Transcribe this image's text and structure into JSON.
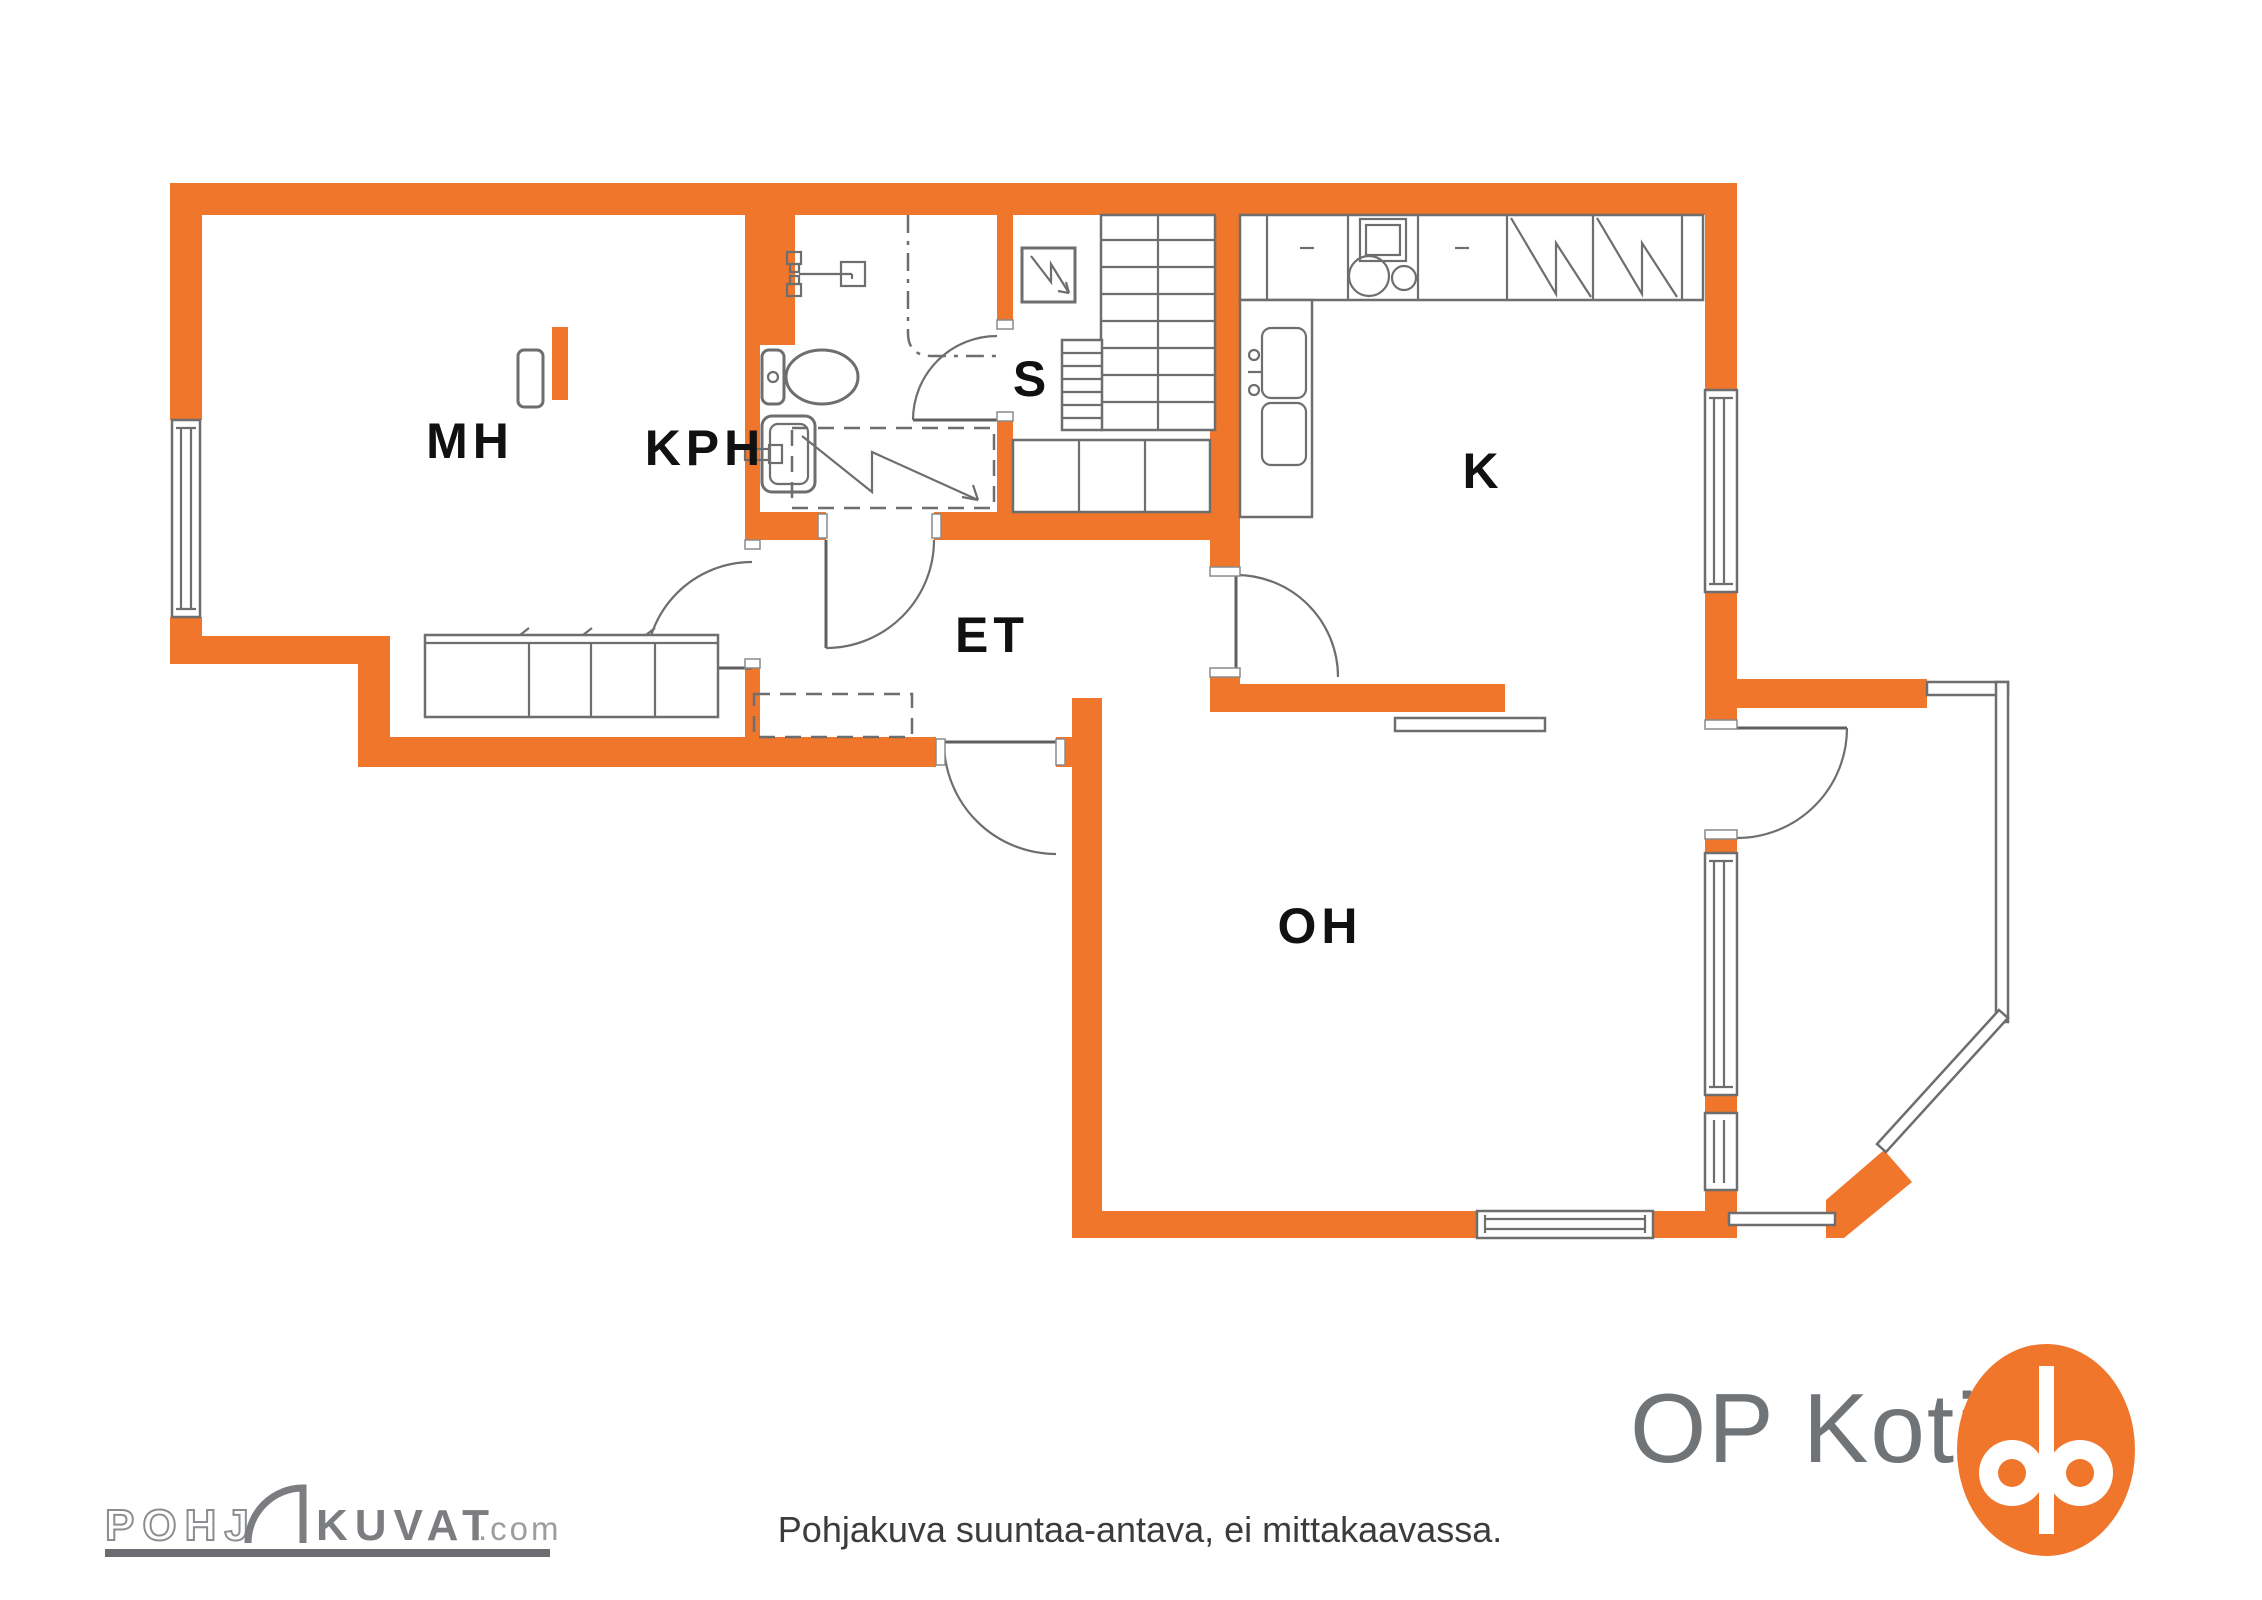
{
  "title": "Floor plan",
  "colors": {
    "wall_orange": "#F0762C",
    "line_gray": "#6E6E6E",
    "label_black": "#111111",
    "brand_gray": "#717477",
    "watermark_gray": "#7B7D80"
  },
  "rooms": {
    "mh": {
      "label": "MH"
    },
    "kph": {
      "label": "KPH"
    },
    "s": {
      "label": "S"
    },
    "et": {
      "label": "ET"
    },
    "k": {
      "label": "K"
    },
    "oh": {
      "label": "OH"
    }
  },
  "icons": [
    "toilet-icon",
    "sink-icon",
    "shower-mixer-icon",
    "shower-floor-icon",
    "sauna-stove-icon",
    "stairs",
    "wardrobe",
    "kitchen-counter",
    "stove-icon",
    "fridge-icon",
    "freezer-icon",
    "kitchen-sink-icon",
    "window",
    "door-arc",
    "balcony",
    "railing",
    "flue-icon"
  ],
  "footer": {
    "disclaimer": "Pohjakuva suuntaa-antava, ei mittakaavassa.",
    "brand": {
      "name": "OP Koti"
    },
    "watermark": {
      "part1": "POHJ",
      "part2": "KUVAT",
      "part3": ".com"
    }
  }
}
